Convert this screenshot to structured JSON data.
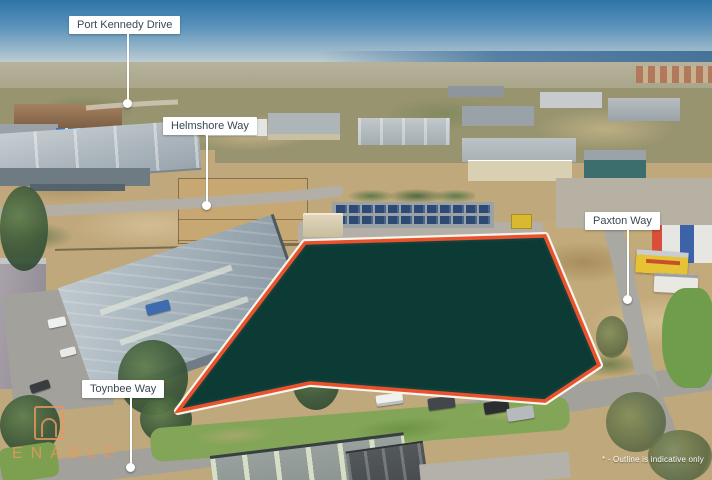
{
  "colors": {
    "parcel_fill": "#0C3A35",
    "parcel_outline": "#E8522C",
    "outline_casing": "#F7F4EC",
    "label_bg": "#FFFFFF",
    "label_text": "#3A4854",
    "watermark": "#E8985F"
  },
  "parcel": {
    "outline_points": "305,243 545,236 599,365 545,401 310,383 178,411"
  },
  "street_labels": [
    {
      "id": "port-kennedy-drive",
      "text": "Port Kennedy Drive"
    },
    {
      "id": "helmshore-way",
      "text": "Helmshore Way"
    },
    {
      "id": "paxton-way",
      "text": "Paxton Way"
    },
    {
      "id": "toynbee-way",
      "text": "Toynbee Way"
    }
  ],
  "watermark": {
    "text": "ENABLE"
  },
  "disclaimer": "* - Outline is indicative only"
}
